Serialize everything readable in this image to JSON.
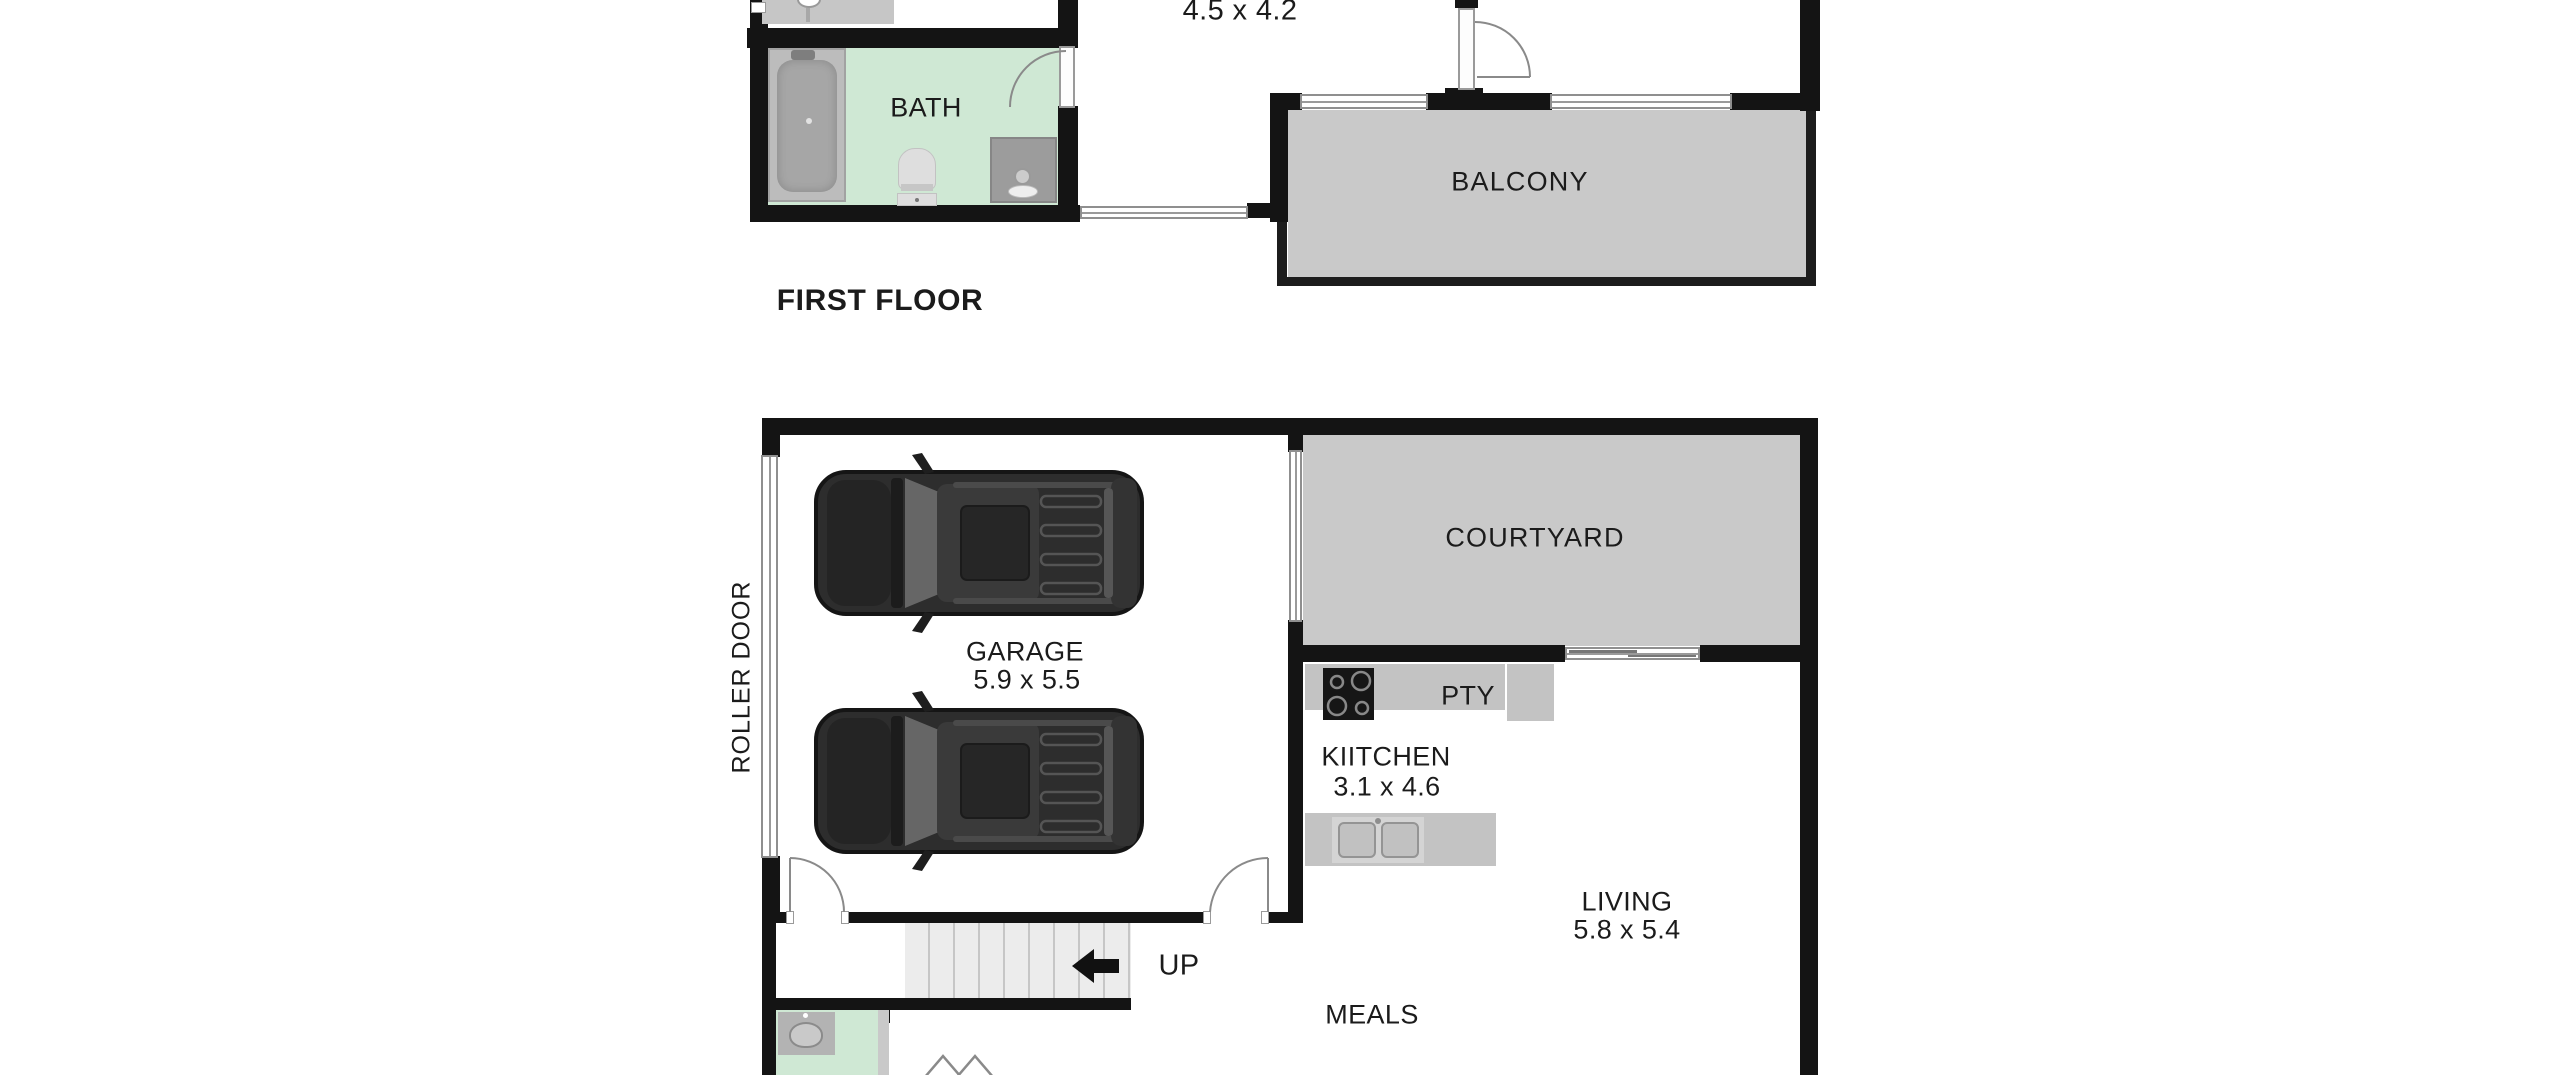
{
  "floorplan": {
    "first_floor": {
      "label": "FIRST FLOOR",
      "rooms": {
        "bath": "BATH",
        "balcony": "BALCONY"
      },
      "bedroom_dimensions": "4.5 x 4.2"
    },
    "ground_floor": {
      "garage": {
        "name": "GARAGE",
        "dimensions": "5.9 x 5.5"
      },
      "roller_door": "ROLLER DOOR",
      "courtyard": "COURTYARD",
      "pantry": "PTY",
      "kitchen": {
        "name": "KIITCHEN",
        "dimensions": "3.1 x 4.6"
      },
      "living": {
        "name": "LIVING",
        "dimensions": "5.8 x 5.4"
      },
      "meals": "MEALS",
      "stair_direction": "UP"
    },
    "colors": {
      "wall": "#141414",
      "room-green": "#cfe8d4",
      "outdoor-gray": "#c9c9c9",
      "counter-gray": "#c3c3c3",
      "fixture-gray": "#9c9c9c",
      "stair-gray": "#ececec",
      "car-dark": "#2d2d2d"
    }
  }
}
